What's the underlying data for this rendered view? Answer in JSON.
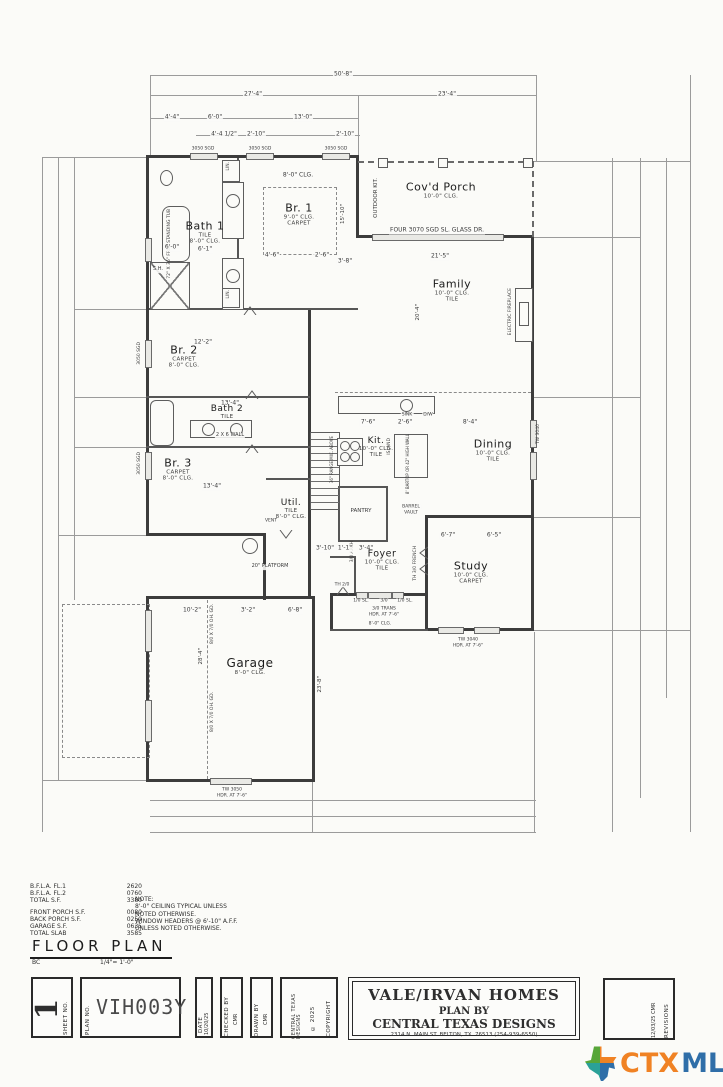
{
  "plan": {
    "rooms": [
      {
        "name": "Bath 1",
        "sub1": "TILE",
        "sub2": "8'-0\" CLG."
      },
      {
        "name": "Br. 1",
        "sub1": "9'-0\" CLG.",
        "sub2": "CARPET"
      },
      {
        "name": "Cov'd Porch",
        "sub1": "10'-0\" CLG.",
        "sub2": ""
      },
      {
        "name": "Family",
        "sub1": "10'-0\" CLG.",
        "sub2": "TILE"
      },
      {
        "name": "Br. 2",
        "sub1": "CARPET",
        "sub2": "8'-0\" CLG."
      },
      {
        "name": "Bath 2",
        "sub1": "TILE",
        "sub2": ""
      },
      {
        "name": "Br. 3",
        "sub1": "CARPET",
        "sub2": "8'-0\" CLG."
      },
      {
        "name": "Kit.",
        "sub1": "10'-0\" CLG.",
        "sub2": "TILE"
      },
      {
        "name": "Dining",
        "sub1": "10'-0\" CLG.",
        "sub2": "TILE"
      },
      {
        "name": "Util.",
        "sub1": "TILE",
        "sub2": "8'-0\" CLG."
      },
      {
        "name": "PANTRY",
        "sub1": "",
        "sub2": ""
      },
      {
        "name": "Foyer",
        "sub1": "10'-0\" CLG.",
        "sub2": "TILE"
      },
      {
        "name": "Study",
        "sub1": "10'-0\" CLG.",
        "sub2": "CARPET"
      },
      {
        "name": "Garage",
        "sub1": "8'-0\" CLG.",
        "sub2": ""
      }
    ],
    "labels": {
      "window": "3050 SGD",
      "glass_door": "FOUR 3070 SGD SL. GLASS DR.",
      "outdoor_kit": "OUTDOOR KIT.",
      "fireplace": "ELECTRIC FIREPLACE",
      "ceiling8": "8'-0\" CLG.",
      "island": "ISLAND",
      "bartop": "8' BARTOP OR 42\" HIGH WALL",
      "range": "36\" RANGE MIC. ABOVE",
      "sink": "SINK",
      "dw": "D/W",
      "tub": "72\" X 36\" FREE STANDING TUB",
      "shower": "S.H.",
      "lin": "LIN.",
      "wall26": "2 X 6 WALL",
      "vent": "VENT",
      "platform": "20\" PLATFORM",
      "ohgd": "8/0 X 7/0 OH. GD.",
      "garage_win": "TW 3050",
      "study_win": "TW 3040",
      "hdr": "HDR. AT 7'-6\"",
      "sl": "1/0 SL.",
      "door30": "3/0",
      "trans": "3/0 TRANS",
      "arch": "3/0 ARCH",
      "french": "TH 3/0 FRENCH",
      "th20": "TH 2/0",
      "barrel1": "BARREL",
      "barrel2": "VAULT"
    },
    "dims": {
      "overall_w": "50'-8\"",
      "left_w": "27'-4\"",
      "right_w": "23'-4\"",
      "a": "4'-4\"",
      "b": "6'-0\"",
      "c": "13'-0\"",
      "d": "4'-4 1/2\"",
      "e": "2'-10\"",
      "br1_w": "15'-10\"",
      "br1_a": "4'-6\"",
      "br1_b": "2'-6\"",
      "br1_c": "3'-8\"",
      "bath1_a": "6'-0\"",
      "bath1_b": "6'-1\"",
      "fam_w": "21'-5\"",
      "fam_h": "20'-4\"",
      "kit_a": "7'-6\"",
      "kit_b": "2'-6\"",
      "kit_c": "8'-4\"",
      "br2_w": "12'-2\"",
      "bath2_w": "13'-4\"",
      "br3_w": "13'-4\"",
      "foy_a": "3'-10\"",
      "foy_b": "1'-1\"",
      "foy_c": "3'-4\"",
      "study_a": "6'-7\"",
      "study_b": "6'-5\"",
      "gar_a": "10'-2\"",
      "gar_b": "3'-2\"",
      "gar_c": "6'-8\"",
      "gar_h": "28'-4\"",
      "gar_h2": "23'-8\""
    }
  },
  "notes": {
    "areas": [
      {
        "label": "B.F.L.A. FL.1",
        "value": "2620"
      },
      {
        "label": "B.F.L.A. FL.2",
        "value": "0760"
      },
      {
        "label": "TOTAL S.F.",
        "value": "3380"
      },
      {
        "label": "FRONT PORCH S.F.",
        "value": "0080"
      },
      {
        "label": "BACK PORCH S.F.",
        "value": "0250"
      },
      {
        "label": "GARAGE S.F.",
        "value": "0635"
      },
      {
        "label": "TOTAL SLAB",
        "value": "3585"
      }
    ],
    "note_title": "NOTE:",
    "note_line1": "8'-0\" CEILING TYPICAL UNLESS",
    "note_line2": "NOTED OTHERWISE.",
    "note_line3": "WINDOW HEADERS @ 6'-10\" A.F.F.",
    "note_line4": "UNLESS NOTED OTHERWISE.",
    "title": "FLOOR PLAN",
    "title_sub": "BC",
    "scale": "1/4\"= 1'-0\""
  },
  "titleblock": {
    "sheet_label": "SHEET NO.",
    "sheet_no": "1",
    "plan_label": "PLAN NO.",
    "plan_no": "VIH003Y",
    "date_label": "DATE",
    "date": "10/20/25",
    "checked_label": "CHECKED BY",
    "checked": "CMR",
    "drawn_label": "DRAWN BY",
    "drawn": "CMR",
    "copyright_l1": "COPYRIGHT",
    "copyright_l2": "© 2025",
    "copyright_l3": "CENTRAL TEXAS DESIGNS",
    "company": "VALE/IRVAN HOMES",
    "plan_by": "PLAN BY",
    "designer": "CENTRAL TEXAS DESIGNS",
    "address": "2314 N. MAIN ST. BELTON, TX. 76513 (254-939-6550)",
    "revisions_label": "REVISIONS",
    "revision_entry": "12/03/25  CMR"
  },
  "logo": {
    "ctx": "CTX",
    "mls": "MLS"
  }
}
